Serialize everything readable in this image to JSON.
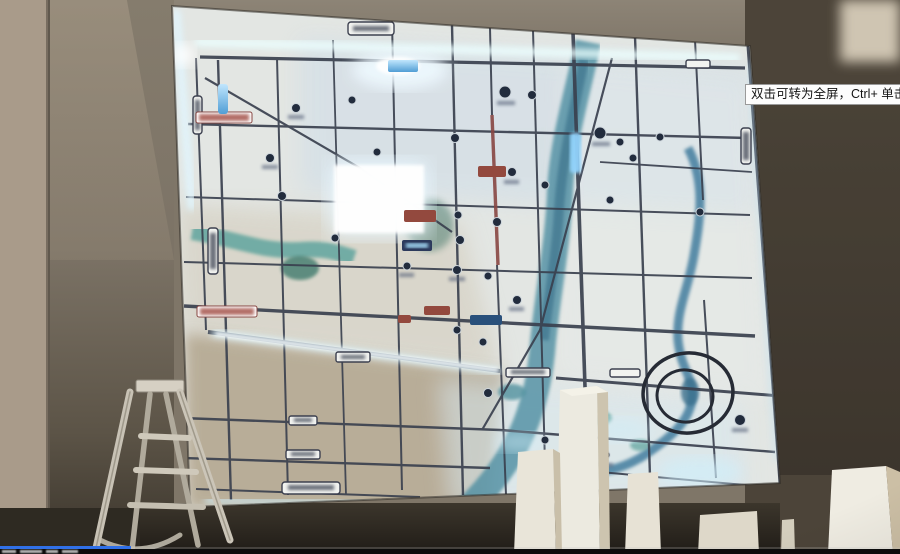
{
  "window": {
    "width": 900,
    "height": 554
  },
  "player": {
    "tooltip_text": "双击可转为全屏，Ctrl+ 单击可转为",
    "progress_played_fraction": 0.145,
    "progress_color": "#3070e8",
    "control_bar_color": "#0c0c0c"
  },
  "scene": {
    "description": "video frame: back-lit district map board on showroom wall, step ladder and white foam pillars in foreground; all map labels too blurred to read",
    "colors": {
      "map_base": "#e3e6e3",
      "map_tan_region": "#b5a88f",
      "road_dark": "#3a4050",
      "road_red": "#8a4540",
      "river_teal": "#4b8fa3",
      "river_green": "#57a39b",
      "led_glow": "#dff6ff",
      "wall_grey": "#7f7668",
      "wall_dark": "#463f35",
      "pill_red": "#96483d",
      "pill_navy": "#2b3a5e",
      "foam_white": "#ece9dd",
      "ladder_aluminium": "#c8c2b4"
    },
    "objects": [
      "map-board",
      "led-edge-glow",
      "rivers",
      "road-grid",
      "poi-badges",
      "road-label-pills",
      "circle-annotation",
      "step-ladder",
      "foam-blocks"
    ]
  }
}
